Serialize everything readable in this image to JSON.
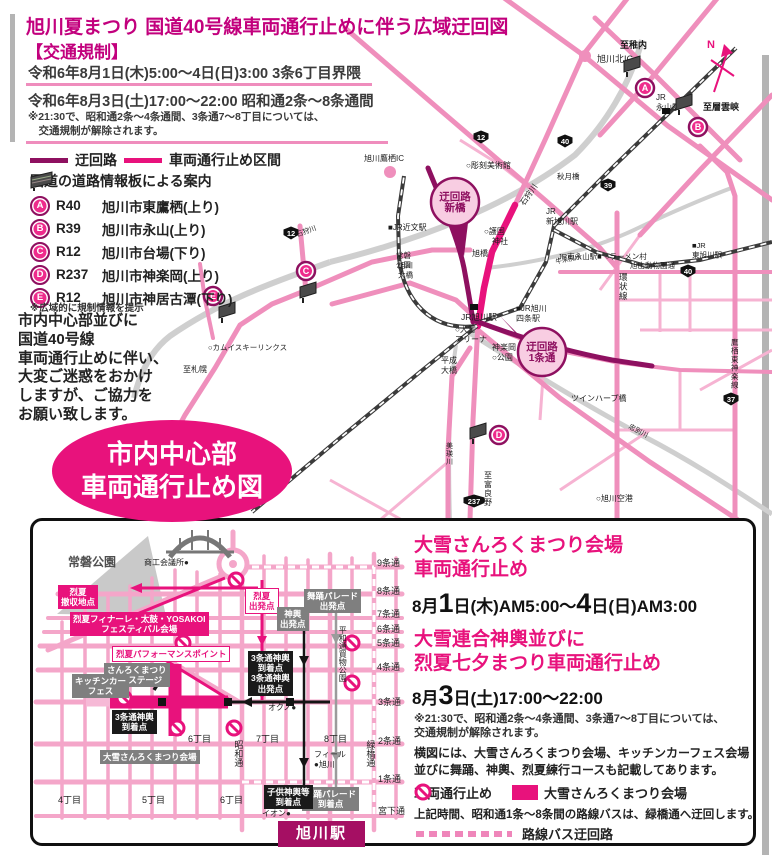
{
  "colors": {
    "heading_magenta": "#c2007d",
    "accent_magenta": "#e8127c",
    "detour_dark": "#8e1060",
    "road_pink": "#ef8fbc",
    "station_box": "#a50f63"
  },
  "header": {
    "title": "旭川夏まつり 国道40号線車両通行止めに伴う広域迂回図",
    "section": "【交通規制】",
    "line1": "令和6年8月1日(木)5:00〜4日(日)3:00 3条6丁目界隈",
    "line2": "令和6年8月3日(土)17:00〜22:00 昭和通2条〜8条通間",
    "note1": "※21:30で、昭和通2条〜4条通間、3条通7〜8丁目については、",
    "note2": "　交通規制が解除されます。"
  },
  "legend": {
    "detour": "迂回路",
    "closed": "車両通行止め区間",
    "board": "国道の道路情報板による案内",
    "items": [
      {
        "id": "A",
        "route": "R40",
        "place": "旭川市東鷹栖(上り)"
      },
      {
        "id": "B",
        "route": "R39",
        "place": "旭川市永山(上り)"
      },
      {
        "id": "C",
        "route": "R12",
        "place": "旭川市台場(下り)"
      },
      {
        "id": "D",
        "route": "R237",
        "place": "旭川市神楽岡(上り)"
      },
      {
        "id": "E",
        "route": "R12",
        "place": "旭川市神居古潭(下り)"
      }
    ],
    "note": "※広域的に規制情報を提示"
  },
  "message": [
    "市内中心部並びに",
    "国道40号線",
    "車両通行止めに伴い、",
    "大変ご迷惑をおかけ",
    "しますが、ご協力を",
    "お願い致します。"
  ],
  "ellipse": [
    "市内中心部",
    "車両通行止め図"
  ],
  "main_map": {
    "north_label": "N",
    "labels": [
      {
        "t": "旭川北IC",
        "x": 597,
        "y": 62,
        "s": 9
      },
      {
        "t": "至稚内",
        "x": 620,
        "y": 48,
        "s": 9,
        "b": 1
      },
      {
        "lines": [
          "JR",
          "永山駅"
        ],
        "x": 656,
        "y": 100,
        "s": 8
      },
      {
        "t": "至層雲峡",
        "x": 703,
        "y": 110,
        "s": 9,
        "b": 1
      },
      {
        "t": "旭川鷹栖IC",
        "x": 364,
        "y": 161,
        "s": 8
      },
      {
        "t": "○彫刻美術館",
        "x": 466,
        "y": 168,
        "s": 8
      },
      {
        "t": "■JR近文駅",
        "x": 388,
        "y": 230,
        "s": 8
      },
      {
        "t": "石狩川",
        "x": 524,
        "y": 206,
        "s": 8,
        "r": -55
      },
      {
        "t": "石狩川",
        "x": 297,
        "y": 237,
        "s": 7,
        "r": -20
      },
      {
        "lines": [
          "○護国",
          "　神社"
        ],
        "x": 484,
        "y": 234,
        "s": 8
      },
      {
        "t": "旭橋",
        "x": 472,
        "y": 256,
        "s": 8
      },
      {
        "lines": [
          "常磐",
          "公園"
        ],
        "x": 396,
        "y": 258,
        "s": 7.5
      },
      {
        "lines": [
          "JR",
          "新旭川駅"
        ],
        "x": 546,
        "y": 214,
        "s": 8
      },
      {
        "t": "JR南永山駅■",
        "x": 558,
        "y": 259,
        "s": 7.5
      },
      {
        "t": "○ラーメン村",
        "x": 605,
        "y": 259,
        "s": 7.5
      },
      {
        "lines": [
          "■JR",
          "東旭川駅"
        ],
        "x": 692,
        "y": 248,
        "s": 7.5
      },
      {
        "t": "旭山動物園通",
        "x": 630,
        "y": 268,
        "s": 7.5
      },
      {
        "t": "環状線",
        "x": 619,
        "y": 280,
        "s": 8.5,
        "v": 1
      },
      {
        "t": "鷹栖東神楽線",
        "x": 731,
        "y": 345,
        "s": 7.5,
        "v": 1
      },
      {
        "t": "秋月橋",
        "x": 557,
        "y": 179,
        "s": 7.5
      },
      {
        "lines": [
          "旭川",
          "大橋"
        ],
        "x": 398,
        "y": 268,
        "s": 7.5
      },
      {
        "t": "JR旭川駅",
        "x": 461,
        "y": 320,
        "s": 8.5
      },
      {
        "lines": [
          "■JR旭川",
          "四条駅"
        ],
        "x": 516,
        "y": 311,
        "s": 8
      },
      {
        "lines": [
          "○大雪",
          "アリーナ"
        ],
        "x": 455,
        "y": 332,
        "s": 8
      },
      {
        "lines": [
          "神楽岡",
          "○公園"
        ],
        "x": 492,
        "y": 350,
        "s": 8
      },
      {
        "lines": [
          "平成",
          "大橋"
        ],
        "x": 441,
        "y": 363,
        "s": 8
      },
      {
        "t": "ツインハープ橋",
        "x": 571,
        "y": 401,
        "s": 8
      },
      {
        "t": "忠別川",
        "x": 628,
        "y": 428,
        "s": 7,
        "r": 28
      },
      {
        "t": "美瑛川",
        "x": 446,
        "y": 448,
        "s": 7,
        "v": 1
      },
      {
        "t": "至富良野",
        "x": 484,
        "y": 478,
        "s": 8,
        "v": 1
      },
      {
        "t": "○旭川空港",
        "x": 596,
        "y": 501,
        "s": 8
      },
      {
        "t": "○カムイスキーリンクス",
        "x": 208,
        "y": 350,
        "s": 7.5
      },
      {
        "t": "至札幌",
        "x": 183,
        "y": 372,
        "s": 8
      },
      {
        "t": "牛朱別川",
        "x": 556,
        "y": 264,
        "s": 6.5,
        "r": -12
      }
    ],
    "markers": [
      {
        "id": "A",
        "x": 645,
        "y": 88
      },
      {
        "id": "B",
        "x": 698,
        "y": 127
      },
      {
        "id": "C",
        "x": 306,
        "y": 271
      },
      {
        "id": "D",
        "x": 499,
        "y": 435
      },
      {
        "id": "E",
        "x": 213,
        "y": 296
      }
    ],
    "signs": [
      {
        "x": 624,
        "y": 58
      },
      {
        "x": 676,
        "y": 96
      },
      {
        "x": 300,
        "y": 284
      },
      {
        "x": 470,
        "y": 425
      },
      {
        "x": 219,
        "y": 304
      }
    ],
    "shields": [
      {
        "n": "12",
        "x": 481,
        "y": 137
      },
      {
        "n": "40",
        "x": 565,
        "y": 141
      },
      {
        "n": "39",
        "x": 608,
        "y": 185
      },
      {
        "n": "12",
        "x": 291,
        "y": 233
      },
      {
        "n": "40",
        "x": 688,
        "y": 271
      },
      {
        "n": "237",
        "x": 474,
        "y": 501
      },
      {
        "n": "37",
        "x": 731,
        "y": 399
      }
    ],
    "callouts": [
      {
        "lines": [
          "迂回路",
          "新橋"
        ],
        "cx": 455,
        "cy": 202,
        "r": 24,
        "tri": "446,220 468,223 464,256"
      },
      {
        "lines": [
          "迂回路",
          "1条通"
        ],
        "cx": 542,
        "cy": 352,
        "r": 24,
        "tri": "524,340 541,361 500,316"
      }
    ],
    "stations": [
      {
        "x": 470,
        "y": 304
      },
      {
        "x": 662,
        "y": 108
      }
    ]
  },
  "inset": {
    "boxes": [
      {
        "type": "magenta",
        "x": 58,
        "y": 585,
        "lines": [
          "烈夏",
          "撤収地点"
        ]
      },
      {
        "type": "magenta",
        "x": 70,
        "y": 612,
        "lines": [
          "烈夏フィナーレ・太鼓・YOSAKOI",
          "フェスティバル会場"
        ]
      },
      {
        "type": "outline",
        "x": 112,
        "y": 646,
        "lines": [
          "烈夏パフォーマンスポイント"
        ]
      },
      {
        "type": "outline",
        "x": 245,
        "y": 588,
        "lines": [
          "烈夏",
          "出発点"
        ]
      },
      {
        "type": "gray",
        "x": 304,
        "y": 589,
        "lines": [
          "舞踊パレード",
          "出発点"
        ]
      },
      {
        "type": "gray",
        "x": 277,
        "y": 607,
        "lines": [
          "神輿",
          "出発点"
        ]
      },
      {
        "type": "gray",
        "x": 104,
        "y": 663,
        "lines": [
          "さんろくまつり",
          "特設ステージ"
        ]
      },
      {
        "type": "gray",
        "x": 72,
        "y": 674,
        "lines": [
          "キッチンカー",
          "フェス"
        ]
      },
      {
        "type": "gray",
        "x": 100,
        "y": 750,
        "lines": [
          "大雪さんろくまつり会場"
        ]
      },
      {
        "type": "gray",
        "x": 302,
        "y": 787,
        "lines": [
          "舞踊パレード",
          "到着点"
        ]
      },
      {
        "type": "black",
        "x": 248,
        "y": 651,
        "lines": [
          "3条通神輿",
          "到着点",
          "3条通神輿",
          "出発点"
        ]
      },
      {
        "type": "black",
        "x": 112,
        "y": 710,
        "lines": [
          "3条通神輿",
          "到着点"
        ]
      },
      {
        "type": "black",
        "x": 264,
        "y": 785,
        "lines": [
          "子供神輿等",
          "到着点"
        ]
      },
      {
        "type": "station",
        "x": 278,
        "y": 821,
        "lines": [
          "旭川駅"
        ]
      }
    ],
    "texts": [
      {
        "t": "常磐公園",
        "x": 68,
        "y": 556,
        "size": 12,
        "bold": 1,
        "color": "#4f4f4f"
      },
      {
        "t": "商工会議所●",
        "x": 144,
        "y": 558,
        "size": 8
      },
      {
        "t": "9条通",
        "x": 377,
        "y": 558,
        "size": 9
      },
      {
        "t": "8条通",
        "x": 377,
        "y": 586,
        "size": 9
      },
      {
        "t": "7条通",
        "x": 377,
        "y": 609,
        "size": 9
      },
      {
        "t": "6条通",
        "x": 377,
        "y": 624,
        "size": 9
      },
      {
        "t": "5条通",
        "x": 377,
        "y": 638,
        "size": 9
      },
      {
        "t": "4条通",
        "x": 377,
        "y": 662,
        "size": 9
      },
      {
        "t": "3条通",
        "x": 378,
        "y": 697,
        "size": 9
      },
      {
        "t": "2条通",
        "x": 378,
        "y": 736,
        "size": 9
      },
      {
        "t": "1条通",
        "x": 378,
        "y": 774,
        "size": 9
      },
      {
        "t": "宮下通",
        "x": 378,
        "y": 806,
        "size": 9
      },
      {
        "t": "6丁目",
        "x": 188,
        "y": 734,
        "size": 9
      },
      {
        "t": "7丁目",
        "x": 256,
        "y": 734,
        "size": 9
      },
      {
        "t": "8丁目",
        "x": 324,
        "y": 734,
        "size": 9
      },
      {
        "t": "4丁目",
        "x": 58,
        "y": 795,
        "size": 9
      },
      {
        "t": "5丁目",
        "x": 142,
        "y": 795,
        "size": 9
      },
      {
        "t": "6丁目",
        "x": 220,
        "y": 795,
        "size": 9
      },
      {
        "t": "昭和通",
        "x": 233,
        "y": 740,
        "size": 9,
        "vert": 1
      },
      {
        "t": "緑橋通",
        "x": 365,
        "y": 740,
        "size": 9,
        "vert": 1
      },
      {
        "t": "平和通買物公園",
        "x": 338,
        "y": 626,
        "size": 8,
        "vert": 1
      },
      {
        "t": "オクノ●",
        "x": 268,
        "y": 703,
        "size": 8
      },
      {
        "t": "フィール",
        "x": 314,
        "y": 750,
        "size": 8
      },
      {
        "t": "●旭川",
        "x": 314,
        "y": 760,
        "size": 8
      },
      {
        "t": "イオン●",
        "x": 262,
        "y": 809,
        "size": 8
      }
    ],
    "no_entry": [
      [
        236,
        580
      ],
      [
        183,
        643
      ],
      [
        352,
        643
      ],
      [
        352,
        683
      ],
      [
        124,
        698
      ],
      [
        177,
        728
      ],
      [
        234,
        728
      ]
    ]
  },
  "panel": {
    "h1a": "大雪さんろくまつり会場",
    "h1b": "車両通行止め",
    "date1": {
      "pre": "8月",
      "b1": "1",
      "mid": "日(木)AM5:00〜",
      "b2": "4",
      "end": "日(日)AM3:00"
    },
    "h2a": "大雪連合神輿並びに",
    "h2b": "烈夏七夕まつり車両通行止め",
    "date2": {
      "pre": "8月",
      "b1": "3",
      "end": "日(土)17:00〜22:00"
    },
    "note1": "※21:30で、昭和通2条〜4条通間、3条通7〜8丁目については、",
    "note2": "交通規制が解除されます。",
    "para1": "横図には、大雪さんろくまつり会場、キッチンカーフェス会場",
    "para2": "並びに舞踊、神輿、烈夏練行コースも記載してあります。",
    "leg_closed": "車両通行止め",
    "leg_venue": "大雪さんろくまつり会場",
    "bus_note": "上記時間、昭和通1条〜8条間の路線バスは、緑橋通へ迂回します。",
    "bus_detour": "路線バス迂回路"
  }
}
